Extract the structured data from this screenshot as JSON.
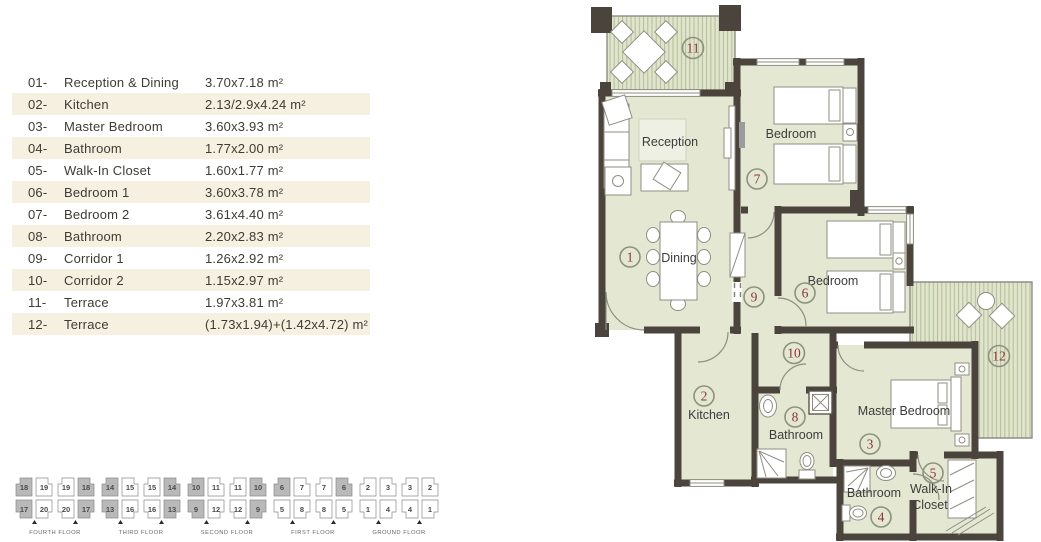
{
  "colors": {
    "wall": "#4a443c",
    "room_fill": "#e4e8d3",
    "terrace_stripe": "#b6c09f",
    "terrace_base": "#e0e5cc",
    "legend_band": "#f6f0e0",
    "marker_ring": "#8d927f",
    "marker_number": "#8c333b"
  },
  "legend": {
    "rows": [
      {
        "num": "01-",
        "name": "Reception & Dining",
        "dims": "3.70x7.18 m²"
      },
      {
        "num": "02-",
        "name": "Kitchen",
        "dims": "2.13/2.9x4.24 m²"
      },
      {
        "num": "03-",
        "name": "Master Bedroom",
        "dims": "3.60x3.93 m²"
      },
      {
        "num": "04-",
        "name": "Bathroom",
        "dims": "1.77x2.00 m²"
      },
      {
        "num": "05-",
        "name": "Walk-In Closet",
        "dims": "1.60x1.77 m²"
      },
      {
        "num": "06-",
        "name": "Bedroom 1",
        "dims": "3.60x3.78 m²"
      },
      {
        "num": "07-",
        "name": "Bedroom 2",
        "dims": "3.61x4.40 m²"
      },
      {
        "num": "08-",
        "name": "Bathroom",
        "dims": "2.20x2.83 m²"
      },
      {
        "num": "09-",
        "name": "Corridor 1",
        "dims": "1.26x2.92 m²"
      },
      {
        "num": "10-",
        "name": "Corridor 2",
        "dims": "1.15x2.97 m²"
      },
      {
        "num": "11-",
        "name": "Terrace",
        "dims": "1.97x3.81 m²"
      },
      {
        "num": "12-",
        "name": "Terrace",
        "dims": "(1.73x1.94)+(1.42x4.72) m²"
      }
    ]
  },
  "plan": {
    "labels": {
      "reception": "Reception",
      "dining": "Dining",
      "bedroom_top": "Bedroom",
      "bedroom_mid": "Bedroom",
      "kitchen": "Kitchen",
      "bathroom_main": "Bathroom",
      "master_bedroom": "Master Bedroom",
      "bathroom_master": "Bathroom",
      "walkin_line1": "Walk-In",
      "walkin_line2": "Closet"
    },
    "markers": {
      "m1": "1",
      "m2": "2",
      "m3": "3",
      "m4": "4",
      "m5": "5",
      "m6": "6",
      "m7": "7",
      "m8": "8",
      "m9": "9",
      "m10": "10",
      "m11": "11",
      "m12": "12"
    }
  },
  "floors": [
    {
      "label": "FOURTH FLOOR",
      "units": [
        "18",
        "19",
        "19",
        "18",
        "17",
        "20",
        "20",
        "17"
      ],
      "shaded": [
        0,
        3,
        4,
        7
      ]
    },
    {
      "label": "THIRD FLOOR",
      "units": [
        "14",
        "15",
        "15",
        "14",
        "13",
        "16",
        "16",
        "13"
      ],
      "shaded": [
        0,
        3,
        4,
        7
      ]
    },
    {
      "label": "SECOND FLOOR",
      "units": [
        "10",
        "11",
        "11",
        "10",
        "9",
        "12",
        "12",
        "9"
      ],
      "shaded": [
        0,
        3,
        4,
        7
      ]
    },
    {
      "label": "FIRST FLOOR",
      "units": [
        "6",
        "7",
        "7",
        "6",
        "5",
        "8",
        "8",
        "5"
      ],
      "shaded": [
        0,
        3
      ]
    },
    {
      "label": "GROUND FLOOR",
      "units": [
        "2",
        "3",
        "3",
        "2",
        "1",
        "4",
        "4",
        "1"
      ],
      "shaded": []
    }
  ]
}
